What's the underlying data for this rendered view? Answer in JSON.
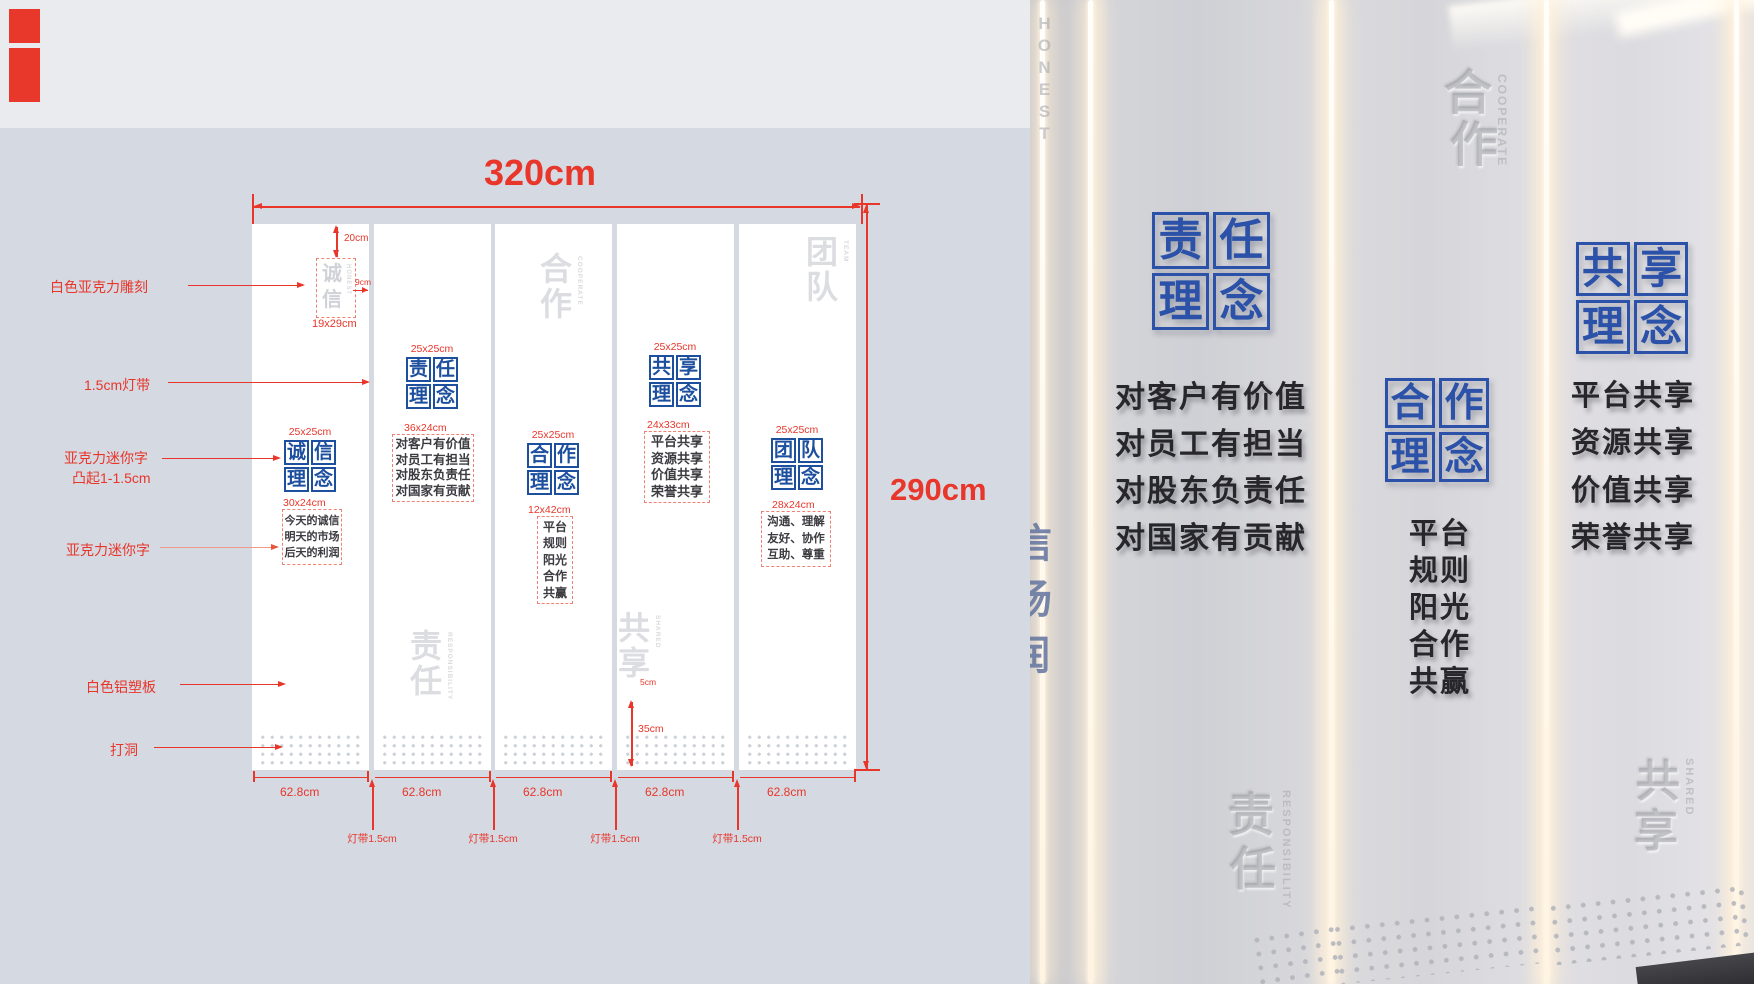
{
  "colors": {
    "diagram_bg": "#d5d9e2",
    "diagram_topband": "#e9ebee",
    "annotation_red": "#e8362a",
    "logo_blue_diagram": "#1d4f9f",
    "logo_blue_photo": "#2b52a8",
    "panel_white": "#ffffff",
    "photo_wall": "#d8d8dc",
    "led_glow": "#ffeed4"
  },
  "diagram": {
    "dim_width": "320cm",
    "dim_height": "290cm",
    "top_offset": "20cm",
    "engrave_size": "19x29cm",
    "engrave_side": "9cm",
    "wm_dim_35": "35cm",
    "wm_dim_5": "5cm",
    "panel_width": "62.8cm",
    "gap_label": "灯带1.5cm",
    "annotations": {
      "engrave": "白色亚克力雕刻",
      "led": "1.5cm灯带",
      "mini1a": "亚克力迷你字",
      "mini1b": "凸起1-1.5cm",
      "mini2": "亚克力迷你字",
      "board": "白色铝塑板",
      "holes": "打洞"
    },
    "engrave_chars": {
      "c1": "诚",
      "c2": "信",
      "en": "HONEST"
    },
    "panels": [
      {
        "logo_size": "25x25cm",
        "logo": [
          "诚",
          "信",
          "理",
          "念"
        ],
        "text_size": "30x24cm",
        "lines": [
          "今天的诚信",
          "明天的市场",
          "后天的利润"
        ]
      },
      {
        "logo_size": "25x25cm",
        "logo": [
          "责",
          "任",
          "理",
          "念"
        ],
        "text_size": "36x24cm",
        "lines": [
          "对客户有价值",
          "对员工有担当",
          "对股东负责任",
          "对国家有贡献"
        ],
        "wm": {
          "c1": "责",
          "c2": "任",
          "en": "RESPONSIBILITY"
        }
      },
      {
        "logo_size": "25x25cm",
        "logo": [
          "合",
          "作",
          "理",
          "念"
        ],
        "text_size": "12x42cm",
        "lines": [
          "平台",
          "规则",
          "阳光",
          "合作",
          "共赢"
        ],
        "wm": {
          "c1": "合",
          "c2": "作",
          "en": "COOPERATE"
        }
      },
      {
        "logo_size": "25x25cm",
        "logo": [
          "共",
          "享",
          "理",
          "念"
        ],
        "text_size": "24x33cm",
        "lines": [
          "平台共享",
          "资源共享",
          "价值共享",
          "荣誉共享"
        ],
        "wm": {
          "c1": "共",
          "c2": "享",
          "en": "SHARED"
        }
      },
      {
        "logo_size": "25x25cm",
        "logo": [
          "团",
          "队",
          "理",
          "念"
        ],
        "text_size": "28x24cm",
        "lines": [
          "沟通、理解",
          "友好、协作",
          "互助、尊重"
        ],
        "wm": {
          "c1": "团",
          "c2": "队",
          "en": "TEAM"
        }
      }
    ]
  },
  "photo": {
    "honest_en": "HONEST",
    "fragments": [
      "信",
      "场",
      "润"
    ],
    "p2": {
      "logo": [
        "责",
        "任",
        "理",
        "念"
      ],
      "lines": [
        "对客户有价值",
        "对员工有担当",
        "对股东负责任",
        "对国家有贡献"
      ],
      "wm": {
        "c1": "责",
        "c2": "任",
        "en": "RESPONSIBILITY"
      }
    },
    "p3": {
      "wm": {
        "c1": "合",
        "c2": "作",
        "en": "COOPERATE"
      },
      "logo": [
        "合",
        "作",
        "理",
        "念"
      ],
      "lines": [
        "平台",
        "规则",
        "阳光",
        "合作",
        "共赢"
      ]
    },
    "p4": {
      "logo": [
        "共",
        "享",
        "理",
        "念"
      ],
      "lines": [
        "平台共享",
        "资源共享",
        "价值共享",
        "荣誉共享"
      ],
      "wm": {
        "c1": "共",
        "c2": "享",
        "en": "SHARED"
      }
    }
  }
}
